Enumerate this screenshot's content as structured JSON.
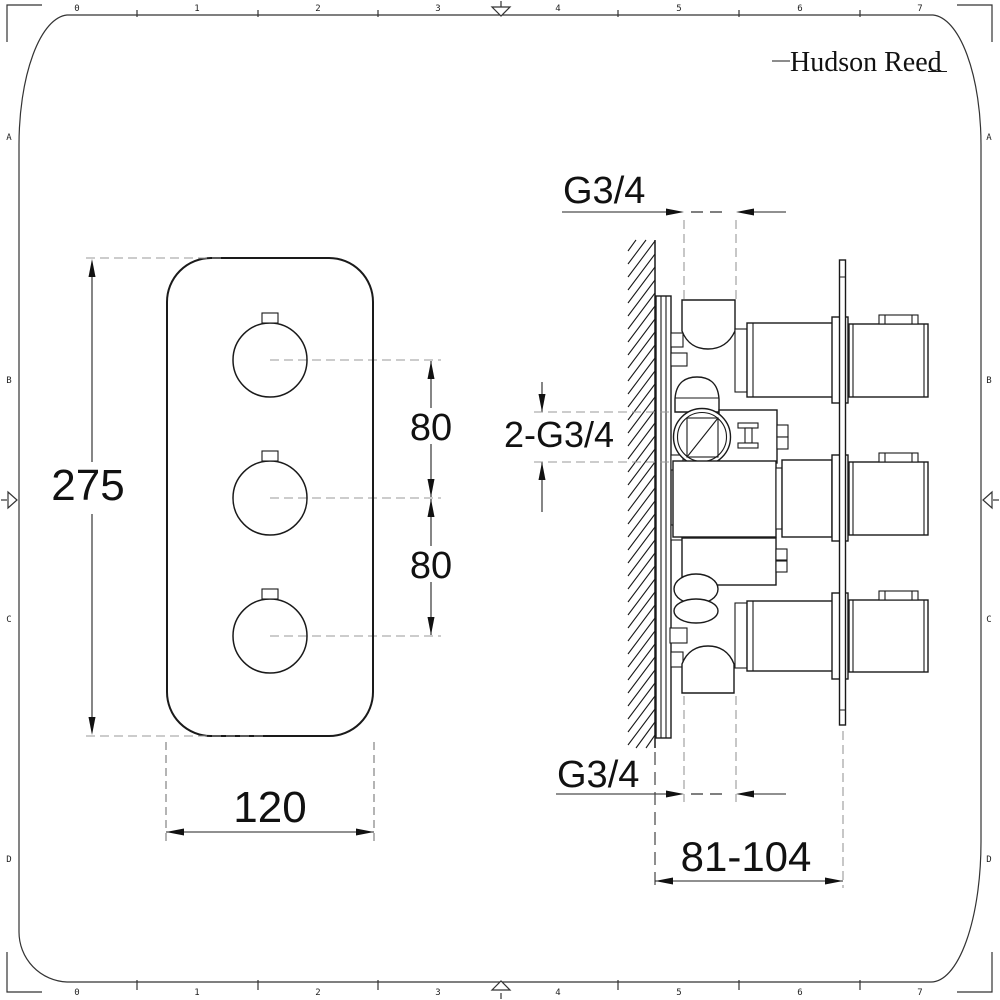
{
  "logo": {
    "text": "Hudson Reed"
  },
  "ruler": {
    "cols": [
      "0",
      "1",
      "2",
      "3",
      "4",
      "5",
      "6",
      "7"
    ],
    "rows": [
      "A",
      "B",
      "C",
      "D"
    ]
  },
  "front_view": {
    "height_mm": "275",
    "width_mm": "120",
    "knob_spacing_top_mm": "80",
    "knob_spacing_bottom_mm": "80"
  },
  "side_view": {
    "top_connection": "G3/4",
    "inlet_connections": "2-G3/4",
    "bottom_connection": "G3/4",
    "installation_depth_mm": "81-104"
  },
  "colors": {
    "ink": "#1a1a1a",
    "dim_line": "#222222",
    "centerline": "#999999",
    "background": "#ffffff"
  }
}
